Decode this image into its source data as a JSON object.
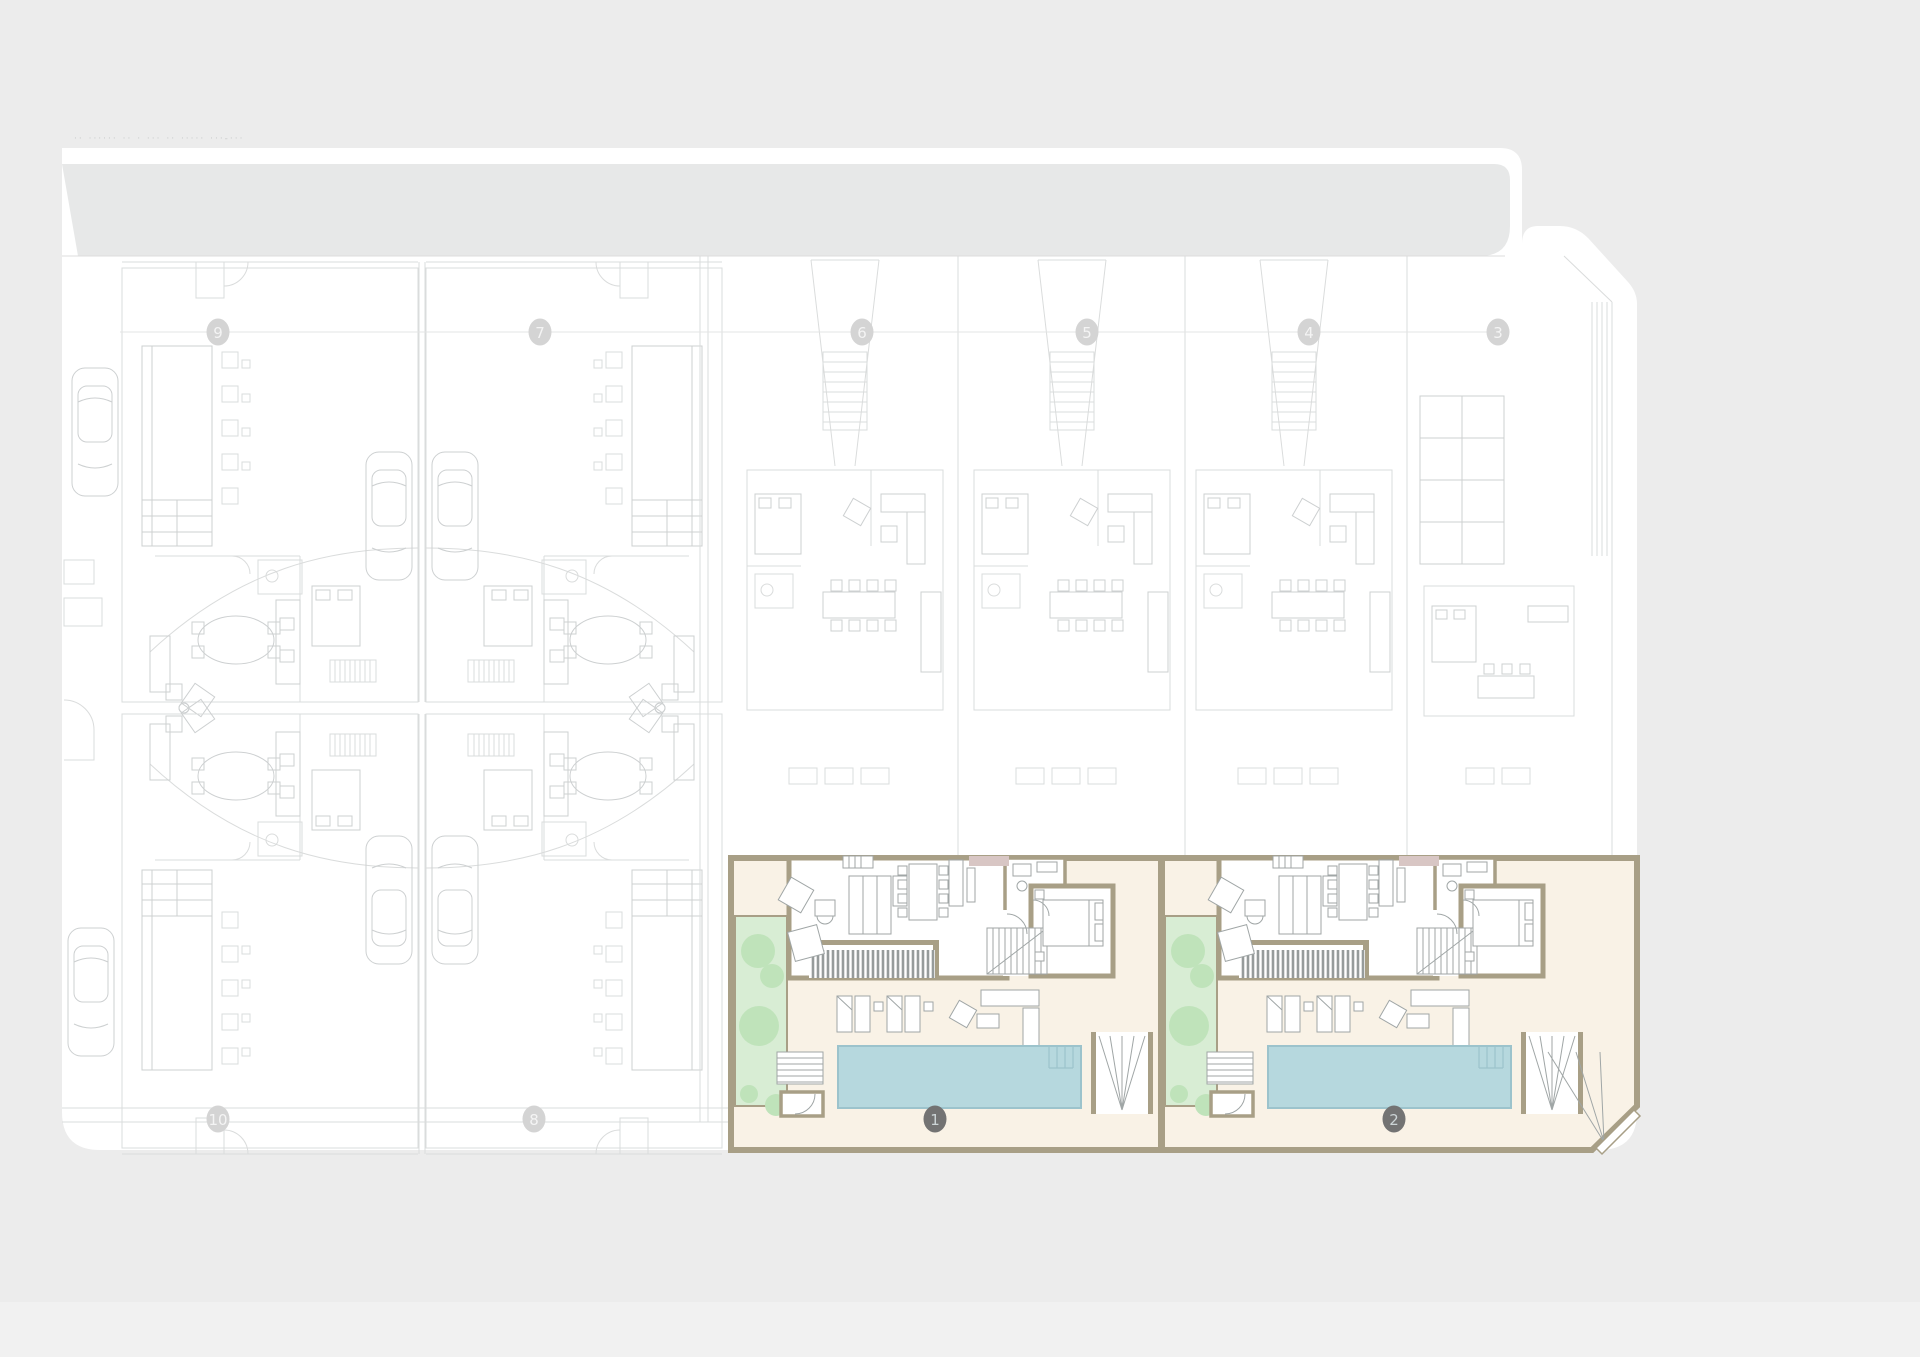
{
  "sheet": {
    "title_text": "·· ······ ··   · ···   ·· ·····   ···-···",
    "title_color": "#c9cbcb"
  },
  "colors": {
    "page": "#ececec",
    "band": "#e7e8e8",
    "faded_line_1": "#dadcdc",
    "faded_line_2": "#cdd0d1",
    "grid_line": "#e3e4e4",
    "wall": "#a89f86",
    "cream": "#f9f2e6",
    "pool": "#b6d8de",
    "pool_edge": "#9cc3cc",
    "garden": "#d8edd4",
    "tree": "#bfe3ba",
    "furniture": "#a0a6a6",
    "deck_stripe": "#969b9b",
    "mauve": "#d8c6c4",
    "bubble_light_fill": "#d4d4d4",
    "bubble_light_text": "#f4f4f4",
    "bubble_dark_fill": "#737373",
    "bubble_dark_text": "#ccd4d6"
  },
  "grid_bubbles": {
    "top_y": 332,
    "bottom_y": 1119,
    "top": [
      {
        "label": "9",
        "x": 218
      },
      {
        "label": "7",
        "x": 540
      },
      {
        "label": "6",
        "x": 862
      },
      {
        "label": "5",
        "x": 1087
      },
      {
        "label": "4",
        "x": 1309
      },
      {
        "label": "3",
        "x": 1498
      }
    ],
    "bottom_light": [
      {
        "label": "10",
        "x": 218
      },
      {
        "label": "8",
        "x": 534
      }
    ],
    "bottom_dark": [
      {
        "label": "1",
        "x": 935
      },
      {
        "label": "2",
        "x": 1394
      }
    ]
  },
  "villas": [
    {
      "name": "highlighted-villa-1",
      "x": 731,
      "y": 856
    },
    {
      "name": "highlighted-villa-2",
      "x": 1161,
      "y": 856
    }
  ],
  "faded_plots_top_right_x": [
    731,
    958,
    1180
  ]
}
